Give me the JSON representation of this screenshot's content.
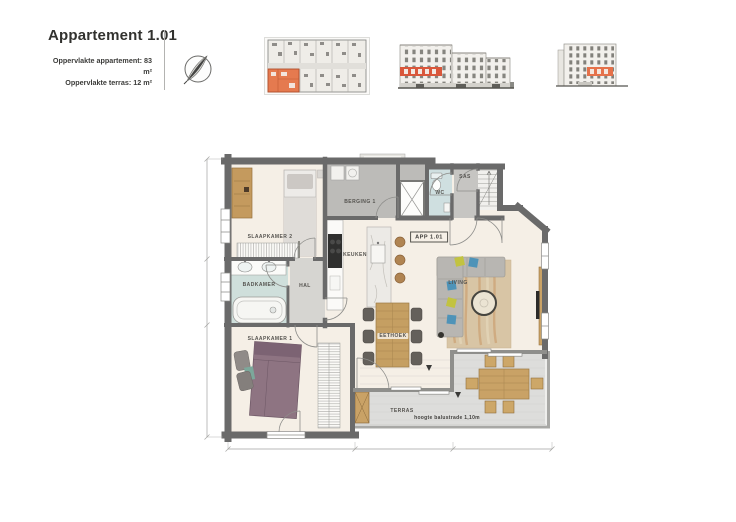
{
  "header": {
    "title": "Appartement 1.01",
    "line1": "Oppervlakte appartement: 83 m²",
    "line2": "Oppervlakte terras: 12 m²"
  },
  "floorplan": {
    "unit_tag": "APP 1.01",
    "rooms": {
      "slaapkamer2": "SLAAPKAMER 2",
      "berging": "BERGING 1",
      "wc": "WC",
      "sas": "SAS",
      "badkamer": "BADKAMER",
      "hal": "HAL",
      "keuken": "KEUKEN",
      "living": "LIVING",
      "eethoek": "EETHOEK",
      "slaapkamer1": "SLAAPKAMER 1",
      "terras": "TERRAS"
    },
    "notes": {
      "balustrade": "hoogte balustrade 1,10m"
    }
  },
  "icons": {
    "compass": "north-compass-icon"
  },
  "colors": {
    "unit_highlight": "#e5714a",
    "walls": "#6a6a6a",
    "floor_beige": "#f5efe6",
    "wet_room_floor": "#cfdfdb",
    "storage_floor": "#bcbbb8",
    "terrace_floor": "#dddddb",
    "wood": "#c9a266",
    "cooktop_black": "#2f2f2e",
    "sofa_gray": "#b8b6b2",
    "pillow_blue": "#4e93b8",
    "pillow_yellow": "#c2c341",
    "bed_mauve": "#8e7482"
  }
}
